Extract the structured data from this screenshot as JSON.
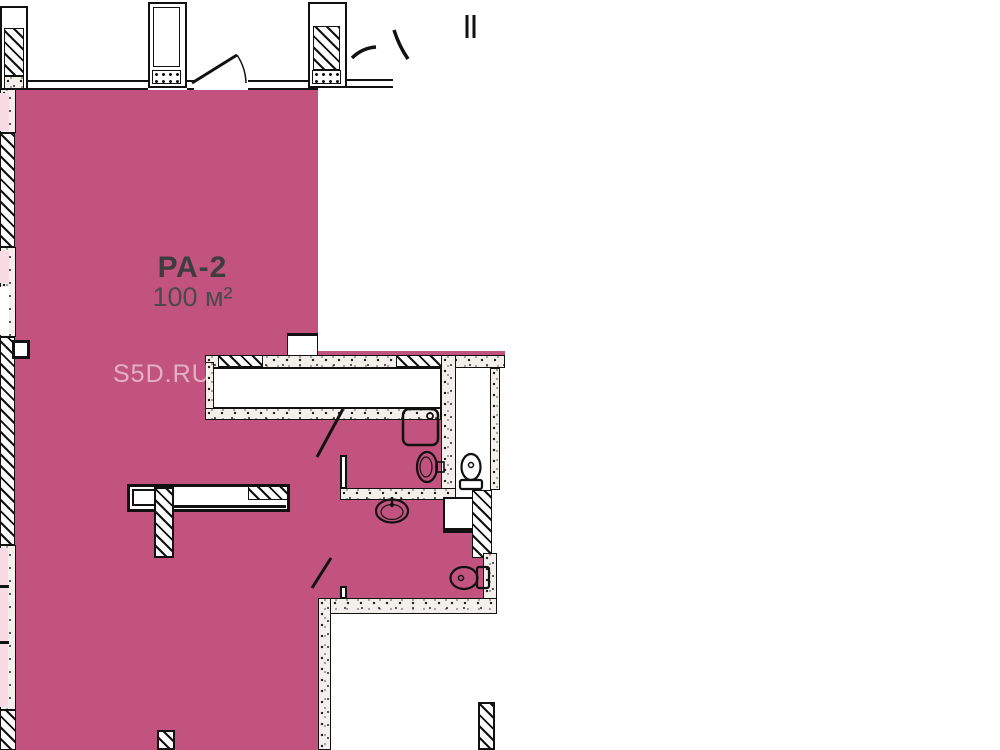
{
  "unit": {
    "id_label": "РА-2",
    "area_label": "100 м²",
    "fill_color": "#c1537e"
  },
  "adjacent": {
    "fill_color": "#f8dbe5"
  },
  "watermark": {
    "text": "S5D.RU"
  },
  "drawing": {
    "line_color": "#111111",
    "fixtures": [
      "shower-tray",
      "washbasin",
      "toilet",
      "washbasin",
      "toilet"
    ]
  }
}
